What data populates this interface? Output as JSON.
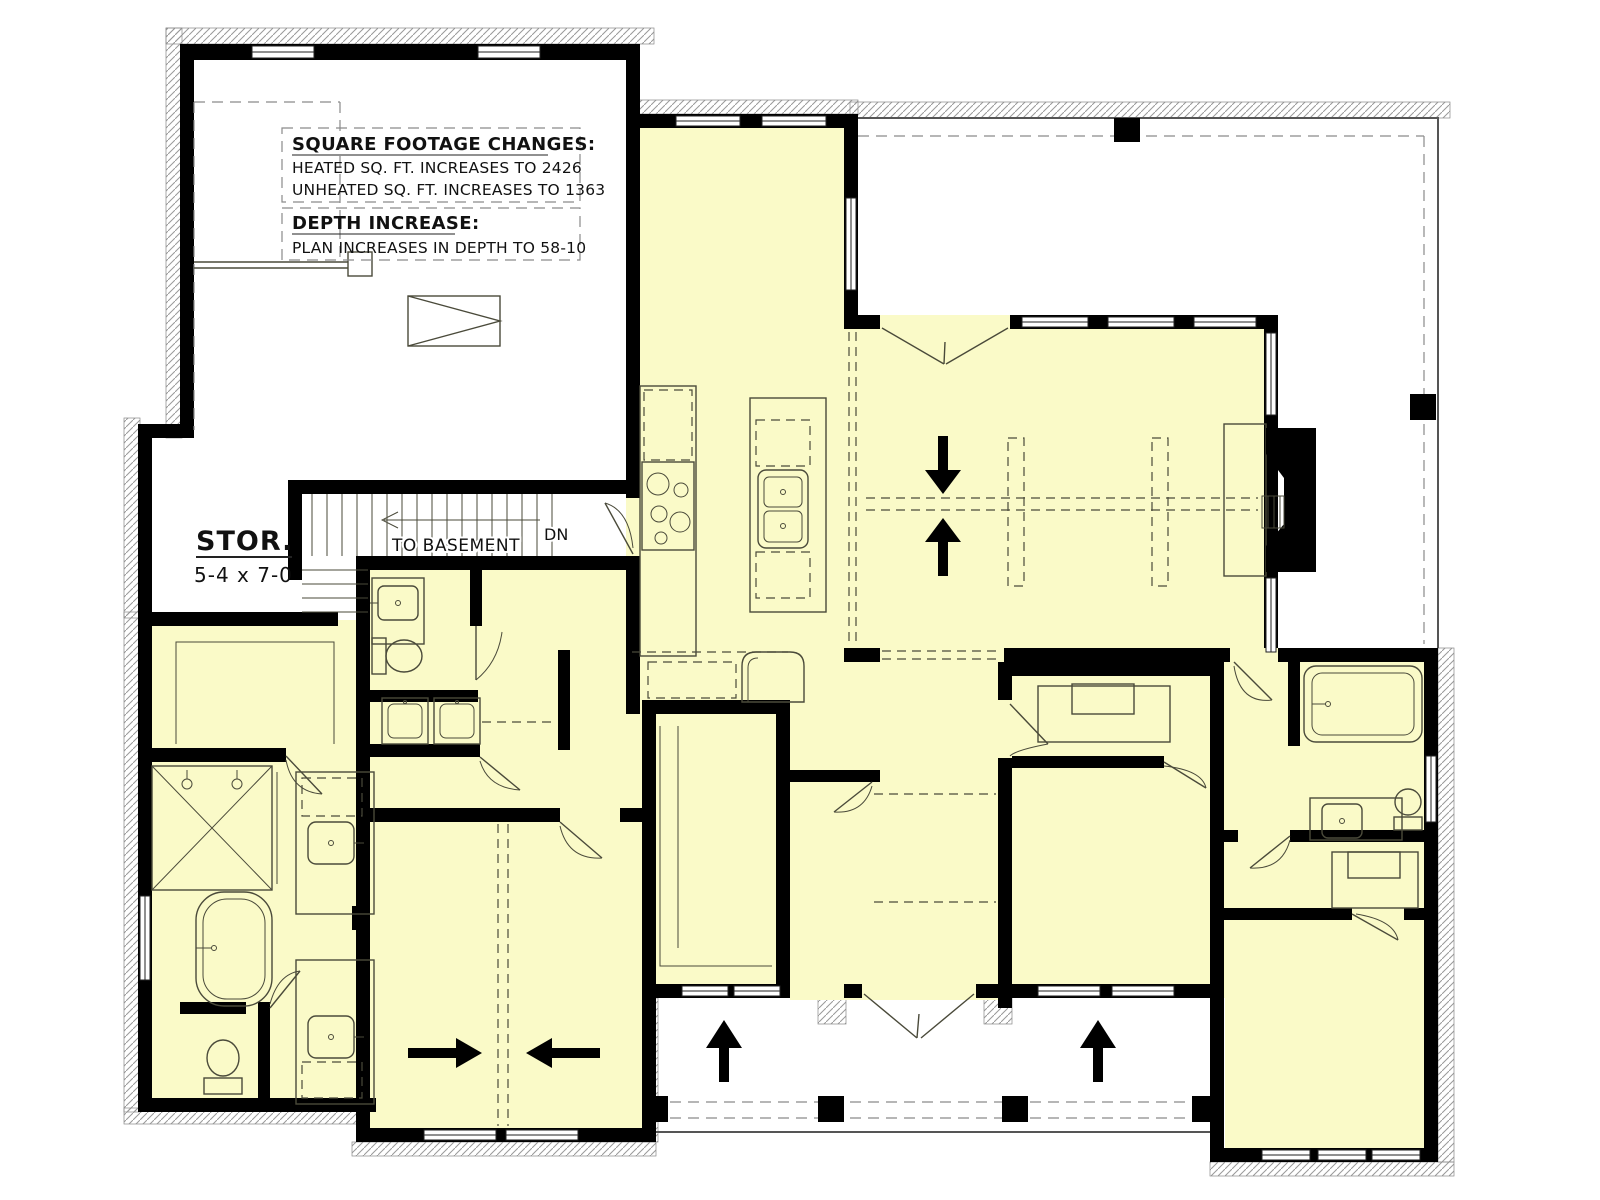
{
  "document": {
    "kind": "architectural-floor-plan",
    "sheet": "modified first floor option"
  },
  "annotations": {
    "sqft_title": "SQUARE FOOTAGE CHANGES:",
    "sqft_heated": "HEATED SQ. FT. INCREASES TO 2426",
    "sqft_unheated": "UNHEATED SQ. FT. INCREASES TO 1363",
    "depth_title": "DEPTH INCREASE:",
    "depth_line": "PLAN INCREASES IN DEPTH TO 58-10"
  },
  "labels": {
    "storage_name": "STOR.",
    "storage_dim": "5-4 x 7-0",
    "stair_direction": "TO BASEMENT",
    "stair_down": "DN"
  },
  "colors": {
    "heated_fill": "#FAFAC8",
    "unheated_fill": "#FFFFFF",
    "wall": "#000000",
    "fixture_line": "#4A4A3A",
    "dash_gray": "#8A8A8A",
    "hatch": "#9A9A9A"
  },
  "icons": {
    "stair_arrow": "arrow-left-open-icon",
    "ridge_arrows": [
      "arrow-down-icon",
      "arrow-up-icon"
    ],
    "expansion_arrows": [
      "arrow-right-icon",
      "arrow-left-icon"
    ],
    "porch_arrows": [
      "arrow-up-icon",
      "arrow-up-icon"
    ]
  }
}
